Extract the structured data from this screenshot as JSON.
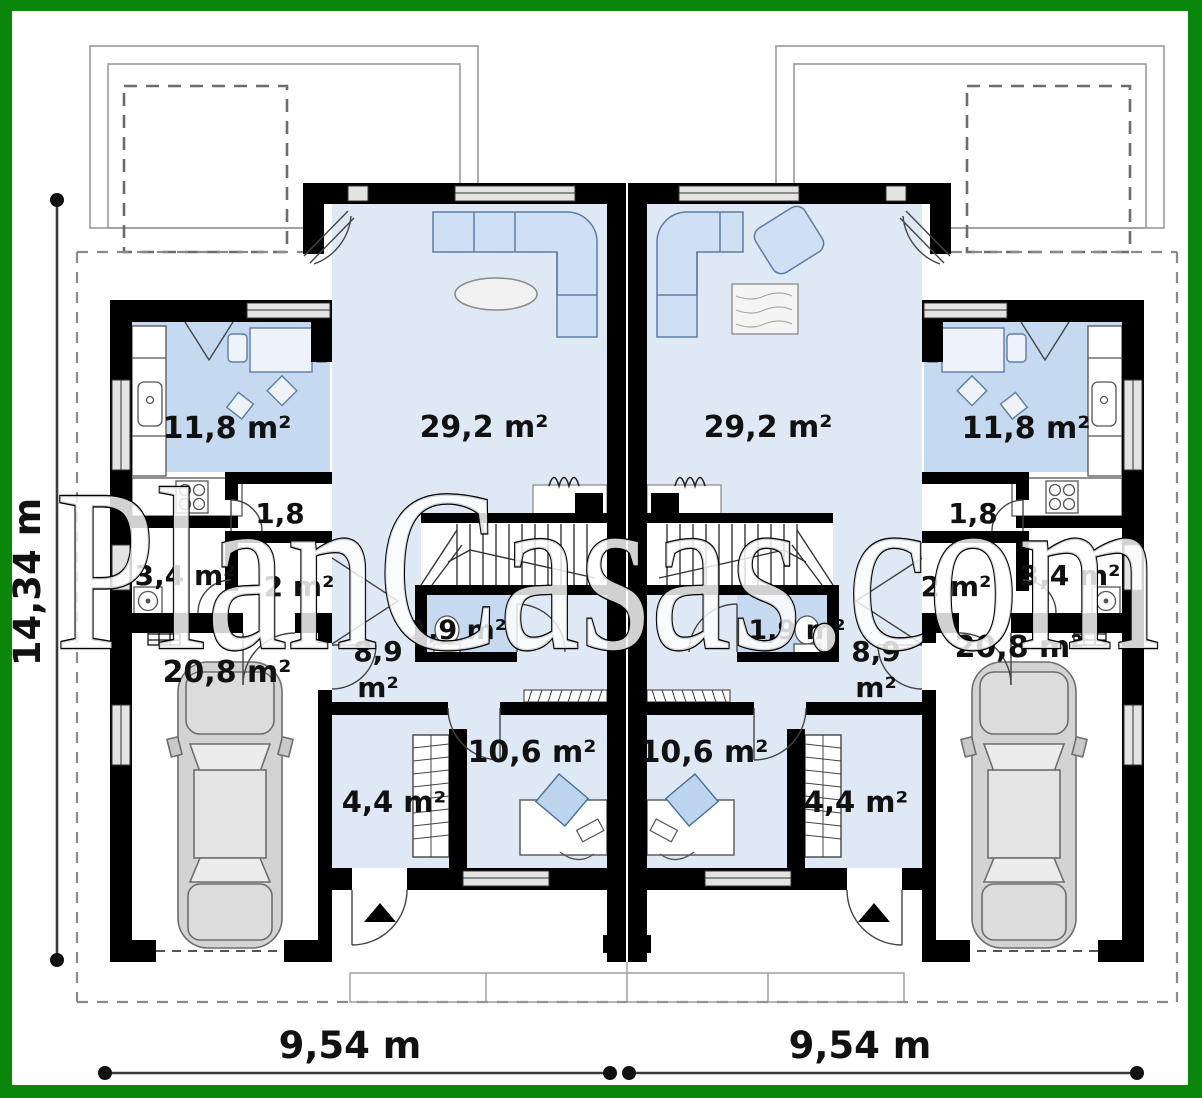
{
  "watermark": "PlanCasas.com",
  "dimensions": {
    "height_total": "14,34 m",
    "width_left_unit": "9,54 m",
    "width_right_unit": "9,54 m"
  },
  "units": {
    "left": {
      "kitchen": "11,8 m²",
      "living_room": "29,2 m²",
      "pantry": "1,8",
      "bathroom": "3,4 m²",
      "hall": "2 m²",
      "wc": "1,9 m²",
      "hallway_line1": "8,9",
      "hallway_line2": "m²",
      "office": "10,6 m²",
      "wardrobe": "4,4 m²",
      "garage": "20,8 m²"
    },
    "right": {
      "kitchen": "11,8 m²",
      "living_room": "29,2 m²",
      "pantry": "1,8",
      "bathroom": "3,4 m²",
      "hall": "2 m²",
      "wc": "1,9 m²",
      "hallway_line1": "8,9",
      "hallway_line2": "m²",
      "office": "10,6 m²",
      "wardrobe": "4,4 m²",
      "garage": "20,8 m²"
    }
  },
  "colors": {
    "frame": "#0a870a",
    "wall": "#000000",
    "room_light": "#dfe8f5",
    "room_medium": "#c5d9f0",
    "furniture": "#cfe0f4",
    "line_gray": "#888888"
  }
}
